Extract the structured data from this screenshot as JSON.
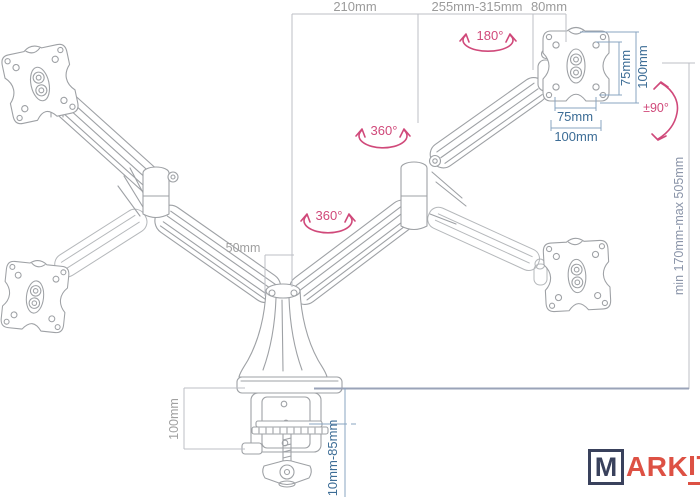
{
  "diagram": {
    "top_dims": {
      "lower_arm_reach": "210mm",
      "upper_arm_reach": "255mm-315mm",
      "head_depth": "80mm"
    },
    "vesa": {
      "vertical_75": "75mm",
      "vertical_100": "100mm",
      "horizontal_75": "75mm",
      "horizontal_100": "100mm"
    },
    "angles": {
      "head_swivel": "180°",
      "upper_joint_rotation": "360°",
      "lower_joint_rotation": "360°",
      "tilt": "±90°"
    },
    "height_range": "min 170mm-max 505mm",
    "pole_offset": "50mm",
    "clamp_height": "100mm",
    "desk_thickness": "10mm-85mm"
  },
  "logo": {
    "boxed_initial": "M",
    "mid": "ARK",
    "tail": "IT"
  },
  "colors": {
    "dim_gray_text": "#9b9b9b",
    "dim_blue_text": "#3d6d96",
    "dim_slate_text": "#8b95a9",
    "accent_pink": "#d0497a",
    "art_line": "#9ea1a5",
    "dim_line": "#bcbfc6",
    "desk_line": "#9aa3b8",
    "logo_navy": "#39415c",
    "logo_red": "#dd5144"
  }
}
